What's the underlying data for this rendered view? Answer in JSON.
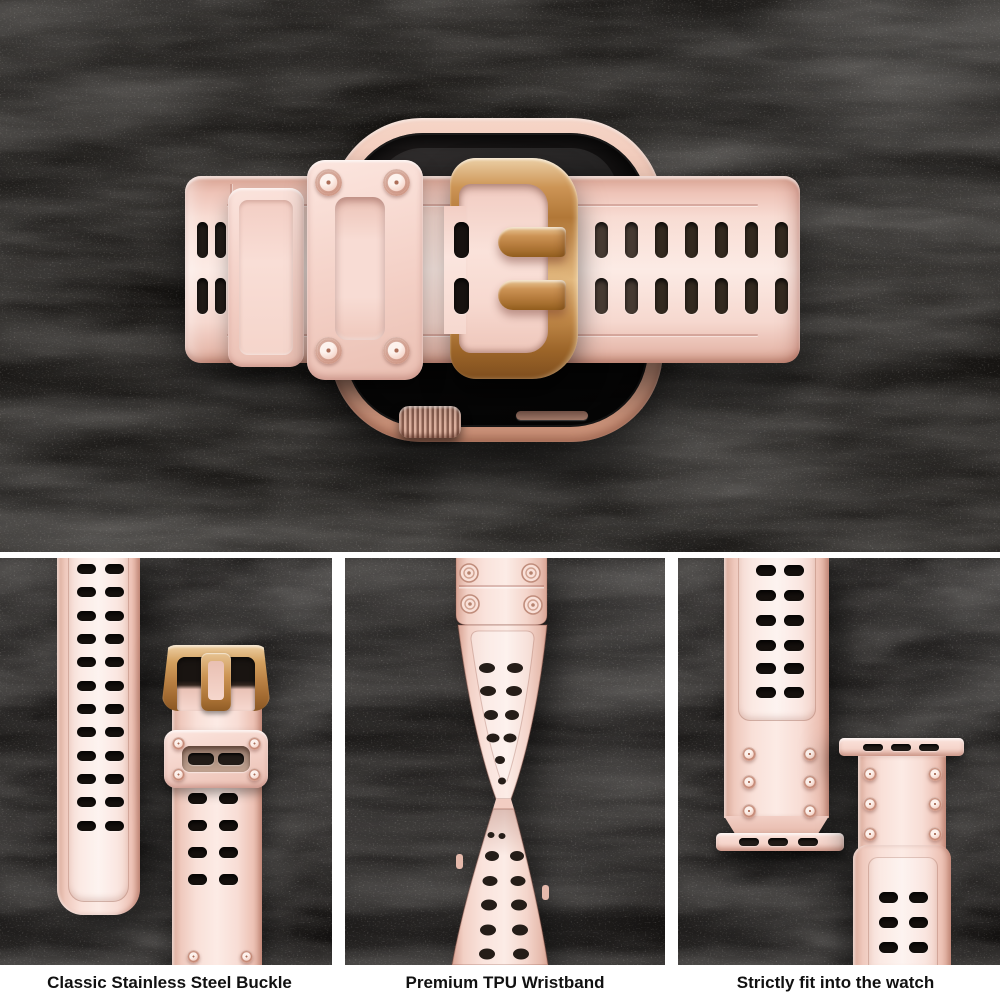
{
  "meta": {
    "type": "product-photo-collage",
    "subject": "Pink rugged TPU smartwatch wristband with rose gold buckle on black suede background"
  },
  "hero": {
    "description": "Top-down view of smartwatch with pink TPU band, rose gold buckle, keeper loop with four screws, digital crown at bottom"
  },
  "panels": [
    {
      "id": "buckle",
      "caption": "Classic Stainless Steel Buckle",
      "description": "Strap with two columns of holes beside buckle, prong, screw keeper block"
    },
    {
      "id": "wristband",
      "caption": "Premium TPU Wristband",
      "description": "Strap twisted to show flexibility of the TPU material"
    },
    {
      "id": "fit",
      "caption": "Strictly fit into the watch",
      "description": "Two strap ends with slotted watch-lug adapter bars and screw rivets"
    }
  ],
  "colors": {
    "background_texture": "#141210",
    "band_pink": "#f9e0d8",
    "band_highlight": "#fcebe5",
    "band_shadow": "#e8bcaf",
    "rose_gold": "#c28a4a",
    "rose_gold_light": "#ecd0a6",
    "watch_case": "#ecc0ae",
    "screen_black": "#0d0c0c",
    "hole_black": "#1c1613",
    "gutter_white": "#ffffff",
    "caption_text": "#111111"
  }
}
